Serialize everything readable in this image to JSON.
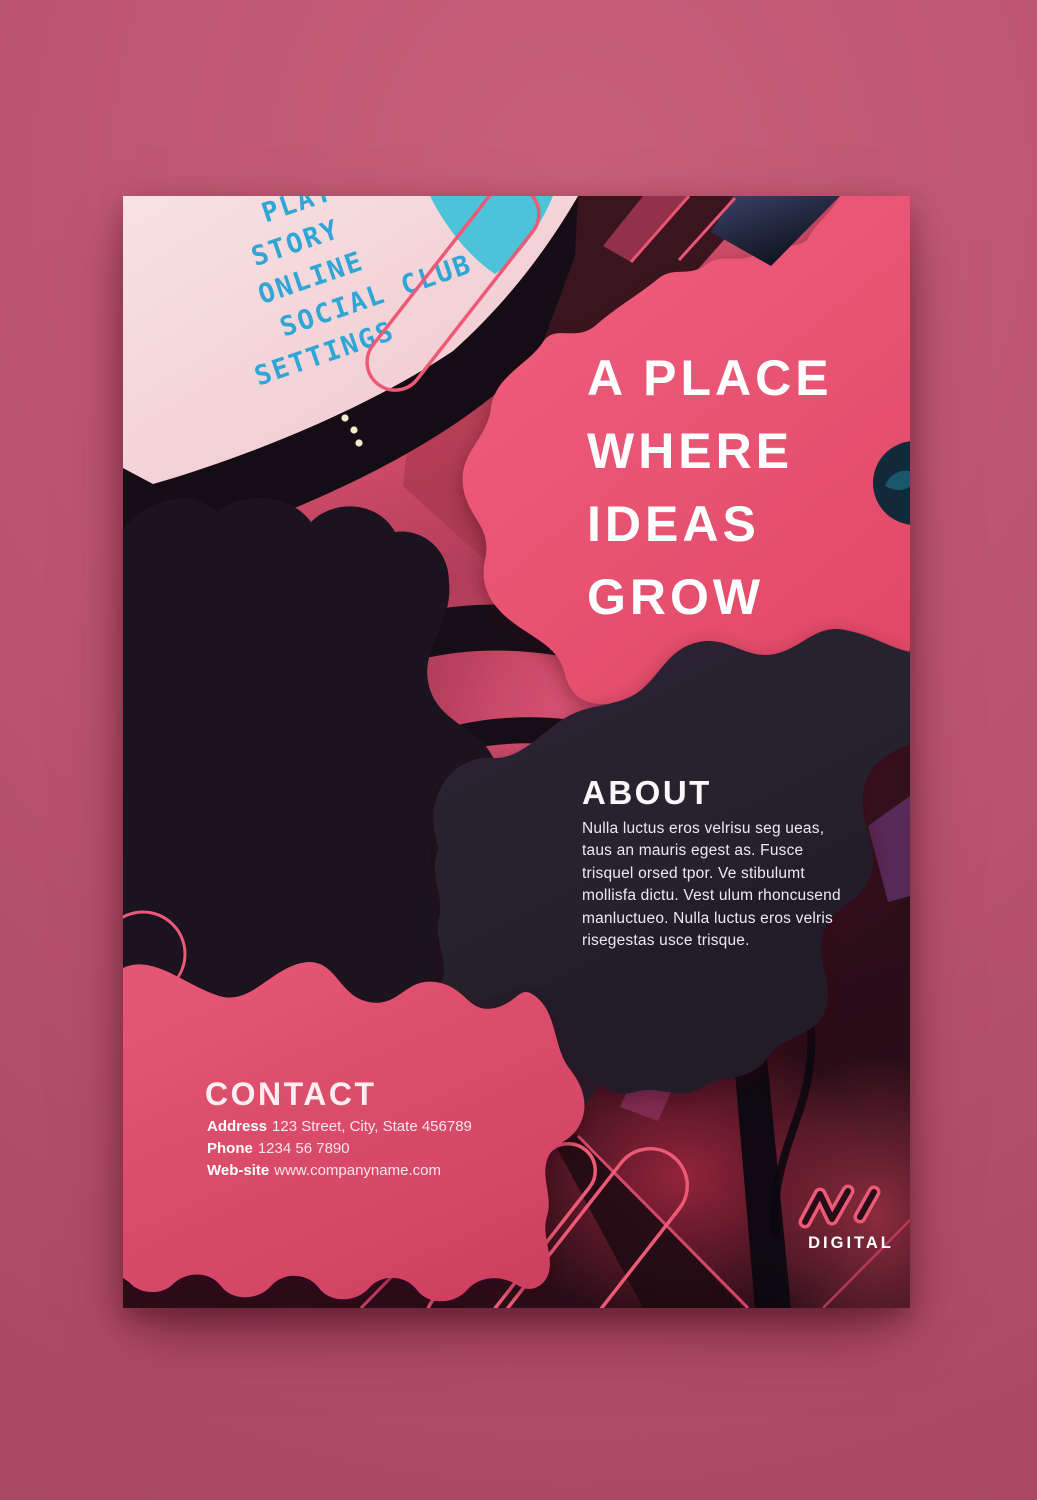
{
  "poster": {
    "headline": {
      "lines": [
        "A PLACE",
        "WHERE",
        "IDEAS",
        "GROW"
      ]
    },
    "about": {
      "title": "ABOUT",
      "body_lines": [
        "Nulla luctus eros velrisu seg ueas,",
        "taus an mauris egest as. Fusce",
        "trisquel orsed tpor. Ve stibulumt",
        "mollisfa dictu. Vest ulum rhoncusend",
        "manluctueo. Nulla luctus eros velris",
        "risegestas usce trisque."
      ]
    },
    "contact": {
      "title": "CONTACT",
      "rows": [
        {
          "label": "Address",
          "value": "123 Street, City, State 456789"
        },
        {
          "label": "Phone",
          "value": "1234 56 7890"
        },
        {
          "label": "Web-site",
          "value": "www.companyname.com"
        }
      ]
    },
    "logo": {
      "text": "DIGITAL"
    },
    "screen_menu": [
      "PLAY",
      "STORY",
      "ONLINE",
      "SOCIAL CLUB",
      "SETTINGS"
    ],
    "colors": {
      "accent_pink": "#ee5a76",
      "dark_blob": "#272230",
      "menu_blue": "#2fa6d6",
      "backdrop_pink": "#bb5470"
    }
  }
}
